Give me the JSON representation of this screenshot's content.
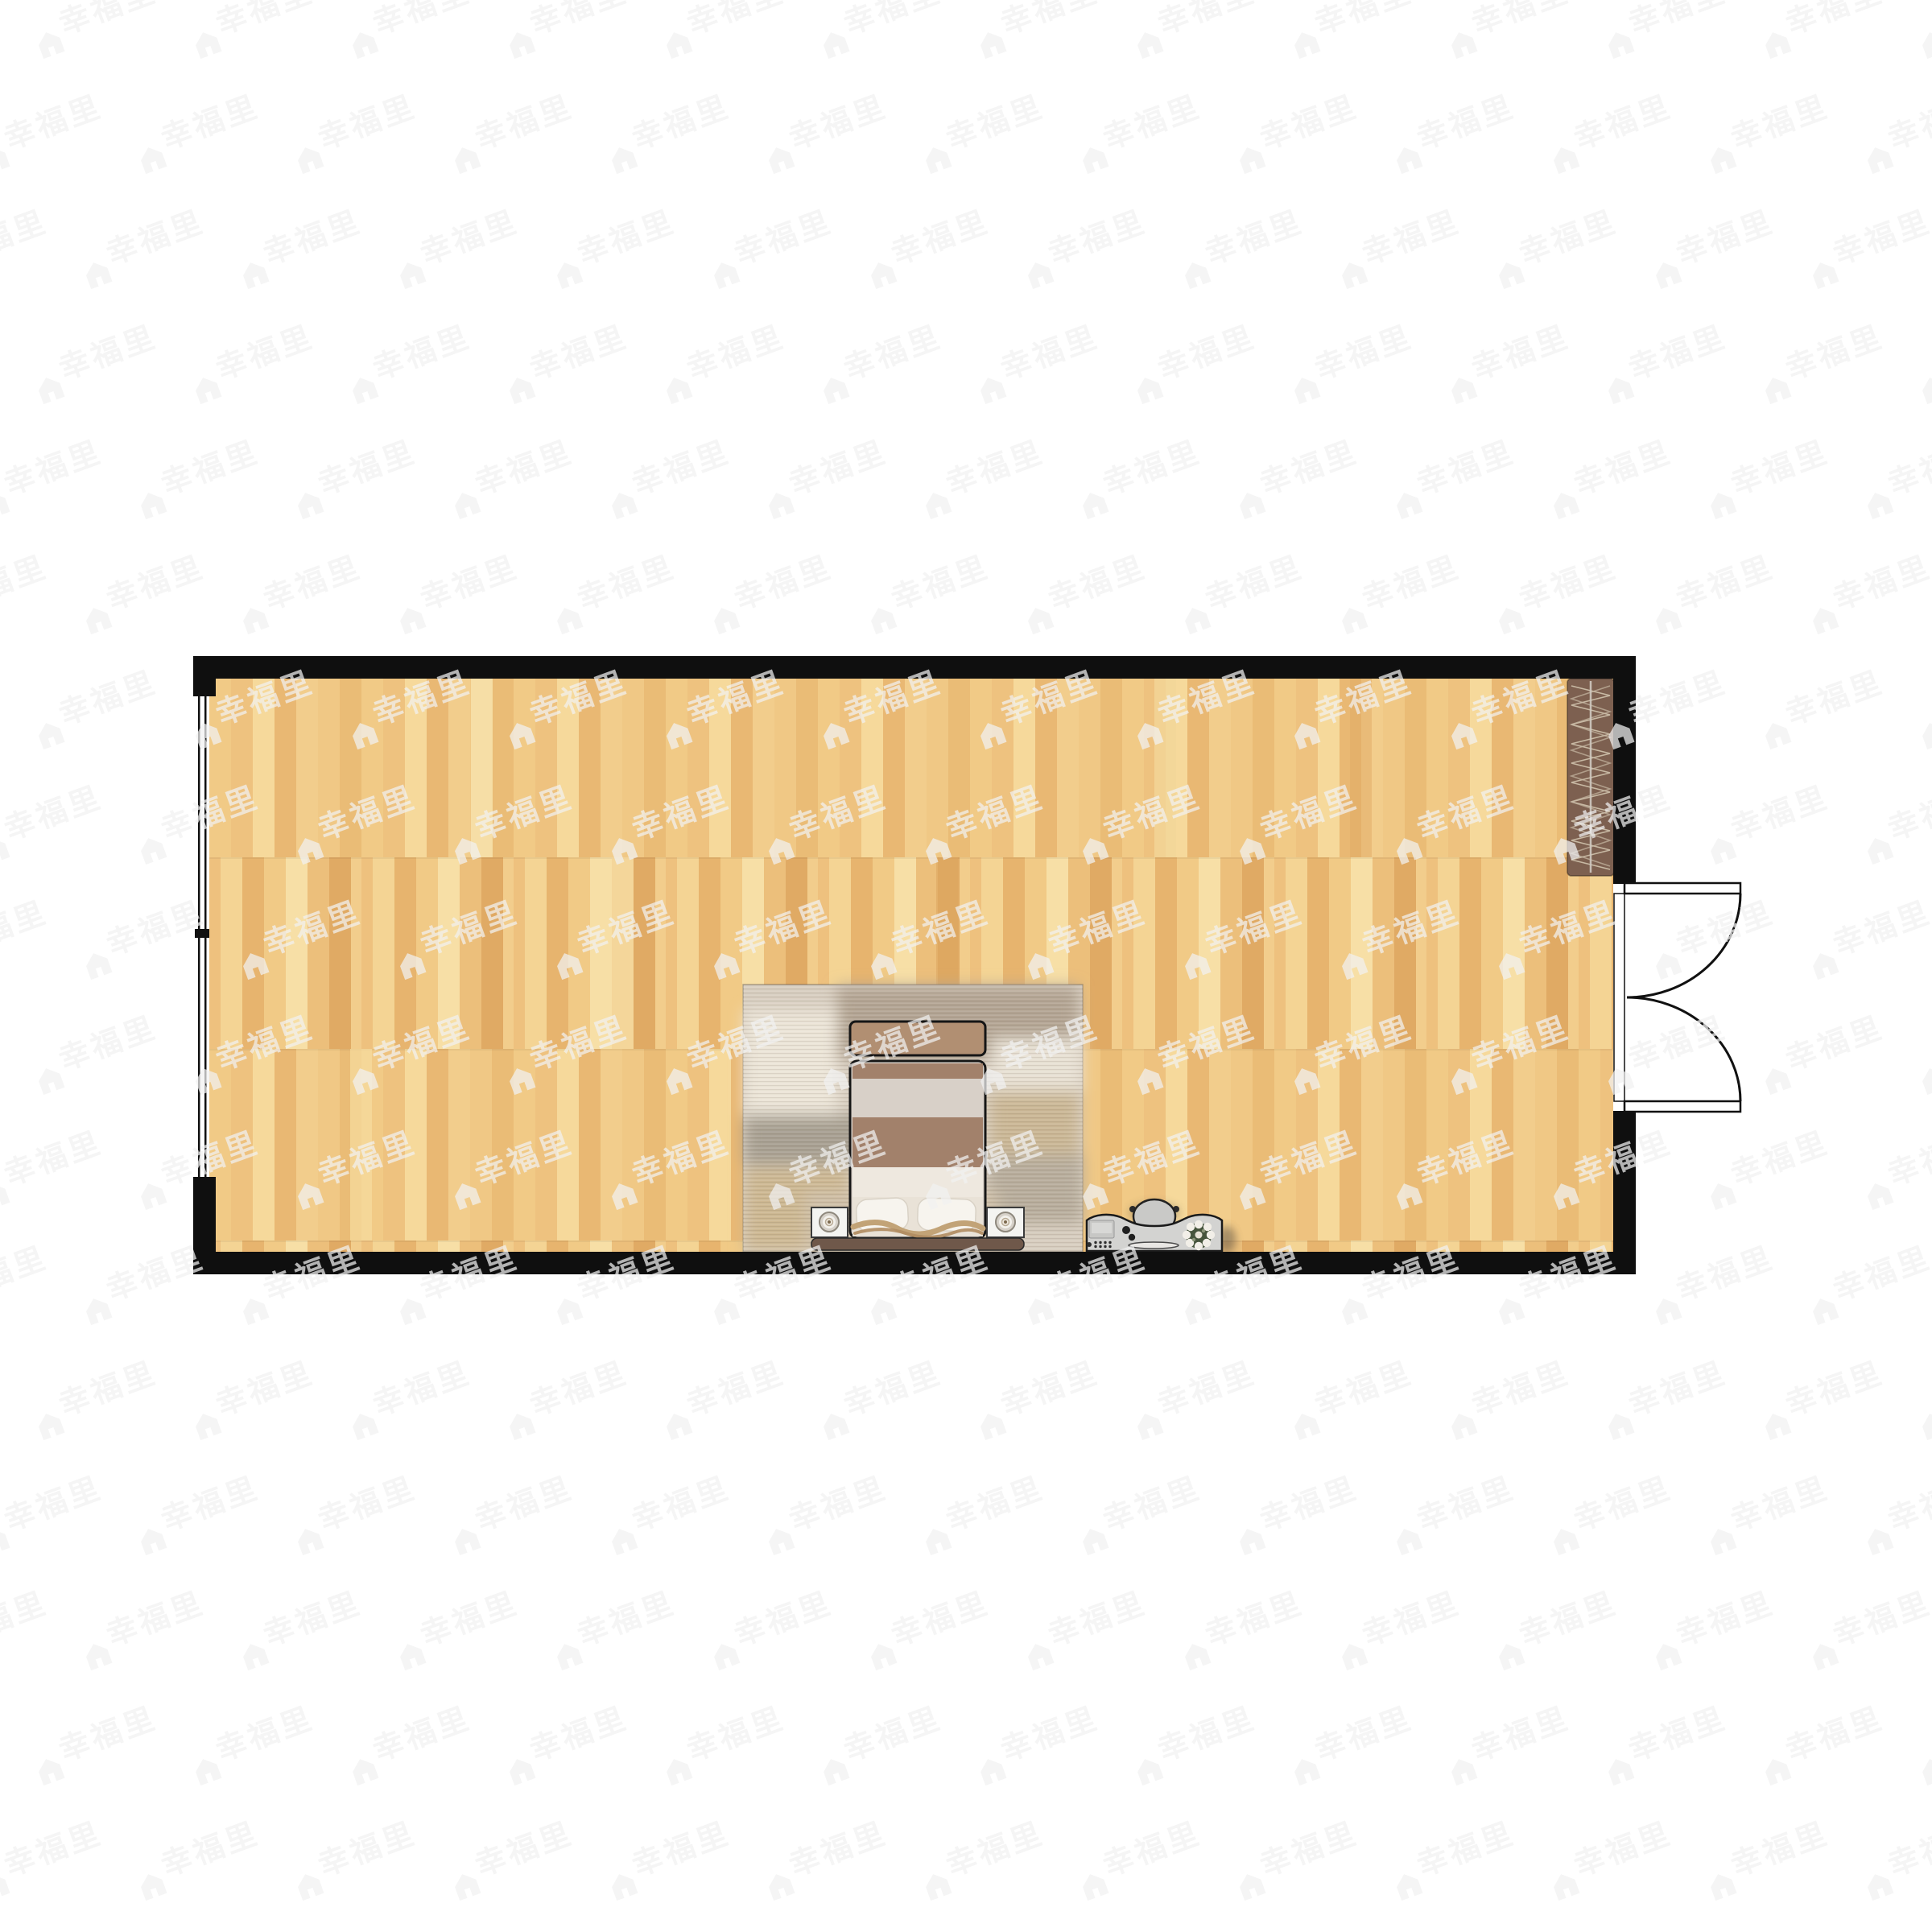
{
  "watermark": {
    "text": "幸福里",
    "icon": "house-icon",
    "color": "#f2f2f2",
    "opacity": 0.72
  },
  "room": {
    "type": "studio floor plan",
    "wall_color": "#0f0f0f",
    "floor": {
      "material": "wood-parquet",
      "palette": [
        "#f1ca86",
        "#eec27f",
        "#f6d99b",
        "#e9b873",
        "#f2cd8c",
        "#f0c885",
        "#eabc76",
        "#e0aa64",
        "#f8e3ae"
      ]
    },
    "furniture": [
      {
        "id": "window-left",
        "label": "window"
      },
      {
        "id": "wardrobe",
        "label": "wardrobe with hanging rail",
        "color": "#7d6050"
      },
      {
        "id": "entry-door",
        "label": "double swing door"
      },
      {
        "id": "area-rug",
        "label": "area rug",
        "color": "#d8cec0"
      },
      {
        "id": "foot-bench",
        "label": "foot bench",
        "color": "#b18f72"
      },
      {
        "id": "double-bed",
        "label": "double bed with pillows"
      },
      {
        "id": "nightstand-left",
        "label": "nightstand with lamp"
      },
      {
        "id": "nightstand-right",
        "label": "nightstand with lamp"
      },
      {
        "id": "desk",
        "label": "desk with chair, laptop and flowers"
      }
    ]
  }
}
